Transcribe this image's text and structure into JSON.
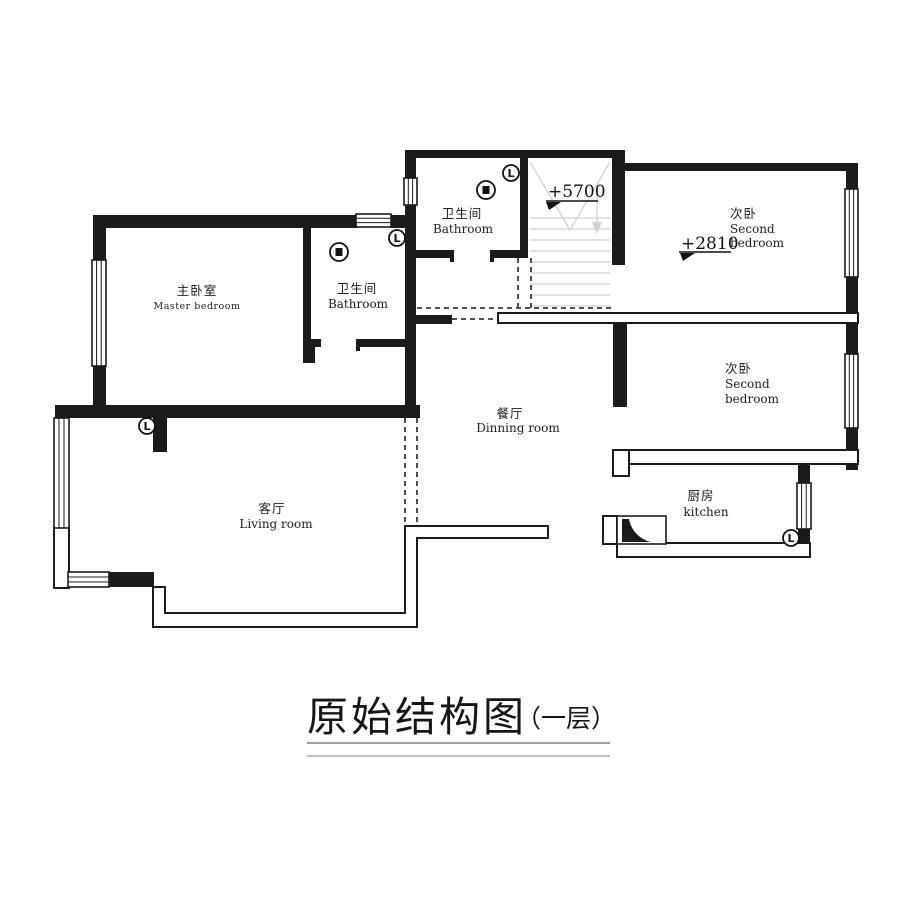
{
  "title": {
    "main": "原始结构图",
    "suffix": "（一层）"
  },
  "floor_plan": {
    "rooms": {
      "bathroom_top": {
        "zh": "卫生间",
        "en": "Bathroom"
      },
      "master_bedroom": {
        "zh": "主卧室",
        "en": "Master bedroom"
      },
      "bathroom_master": {
        "zh": "卫生间",
        "en": "Bathroom"
      },
      "second_bedroom_top": {
        "zh": "次卧",
        "en_line1": "Second",
        "en_line2": "bedroom",
        "elevation": "+2810"
      },
      "dining_room": {
        "zh": "餐厅",
        "en": "Dinning room"
      },
      "second_bedroom_mid": {
        "zh": "次卧",
        "en_line1": "Second",
        "en_line2": "bedroom"
      },
      "kitchen": {
        "zh": "厨房",
        "en": "kitchen"
      },
      "living_room": {
        "zh": "客厅",
        "en": "Living room"
      }
    },
    "stairs": {
      "elevation": "+5700"
    },
    "symbols": {
      "switch_label": "L"
    }
  },
  "colors": {
    "wall": "#1b1b1b",
    "stair_tread": "#d2d2d2",
    "dashed_line": "#3a3a3a",
    "text": "#1d1d1d"
  }
}
